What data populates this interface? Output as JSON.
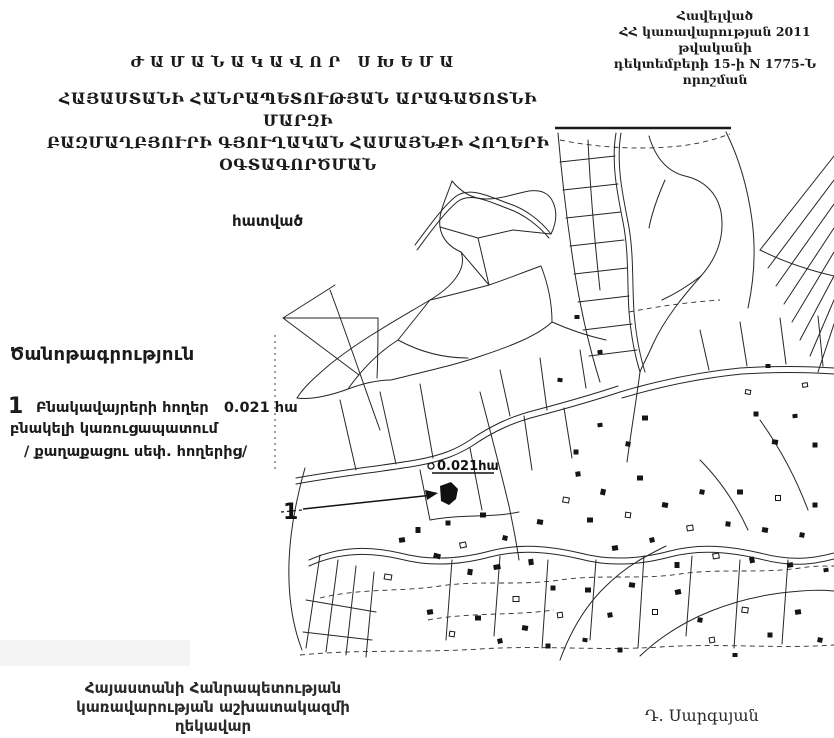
{
  "appendix": {
    "lines": [
      "Հավելված",
      "ՀՀ կառավարության 2011 թվականի",
      "դեկտեմբերի 15-ի N 1775-Ն որոշման"
    ]
  },
  "title": "ԺԱՄԱՆԱԿԱՎՈՐ ՍԽԵՄԱ",
  "subtitle": {
    "lines": [
      "ՀԱՅԱՍՏԱՆԻ ՀԱՆՐԱՊԵՏՈՒԹՅԱՆ ԱՐԱԳԱԾՈՏՆԻ ՄԱՐԶԻ",
      "ԲԱԶՄԱՂԲՅՈՒՐԻ ԳՅՈՒՂԱԿԱՆ ՀԱՄԱՅՆՔԻ ՀՈՂԵՐԻ",
      "ՕԳՏԱԳՈՐԾՄԱՆ"
    ]
  },
  "map": {
    "section_label": "հատված",
    "parcel_label": "0.021հա",
    "parcel_number": "1"
  },
  "legend": {
    "heading": "Ծանոթագրություն",
    "item_number": "1",
    "item_line1": "Բնակավայրերի հողեր   0.021 հա",
    "item_line2": "բնակելի կառուցապատում",
    "item_line3": "/ քաղաքացու սեփ. հողերից/"
  },
  "signature": {
    "office_lines": [
      "Հայաստանի Հանրապետության",
      "կառավարության աշխատակազմի",
      "ղեկավար"
    ],
    "name": "Դ. Սարգսյան"
  }
}
